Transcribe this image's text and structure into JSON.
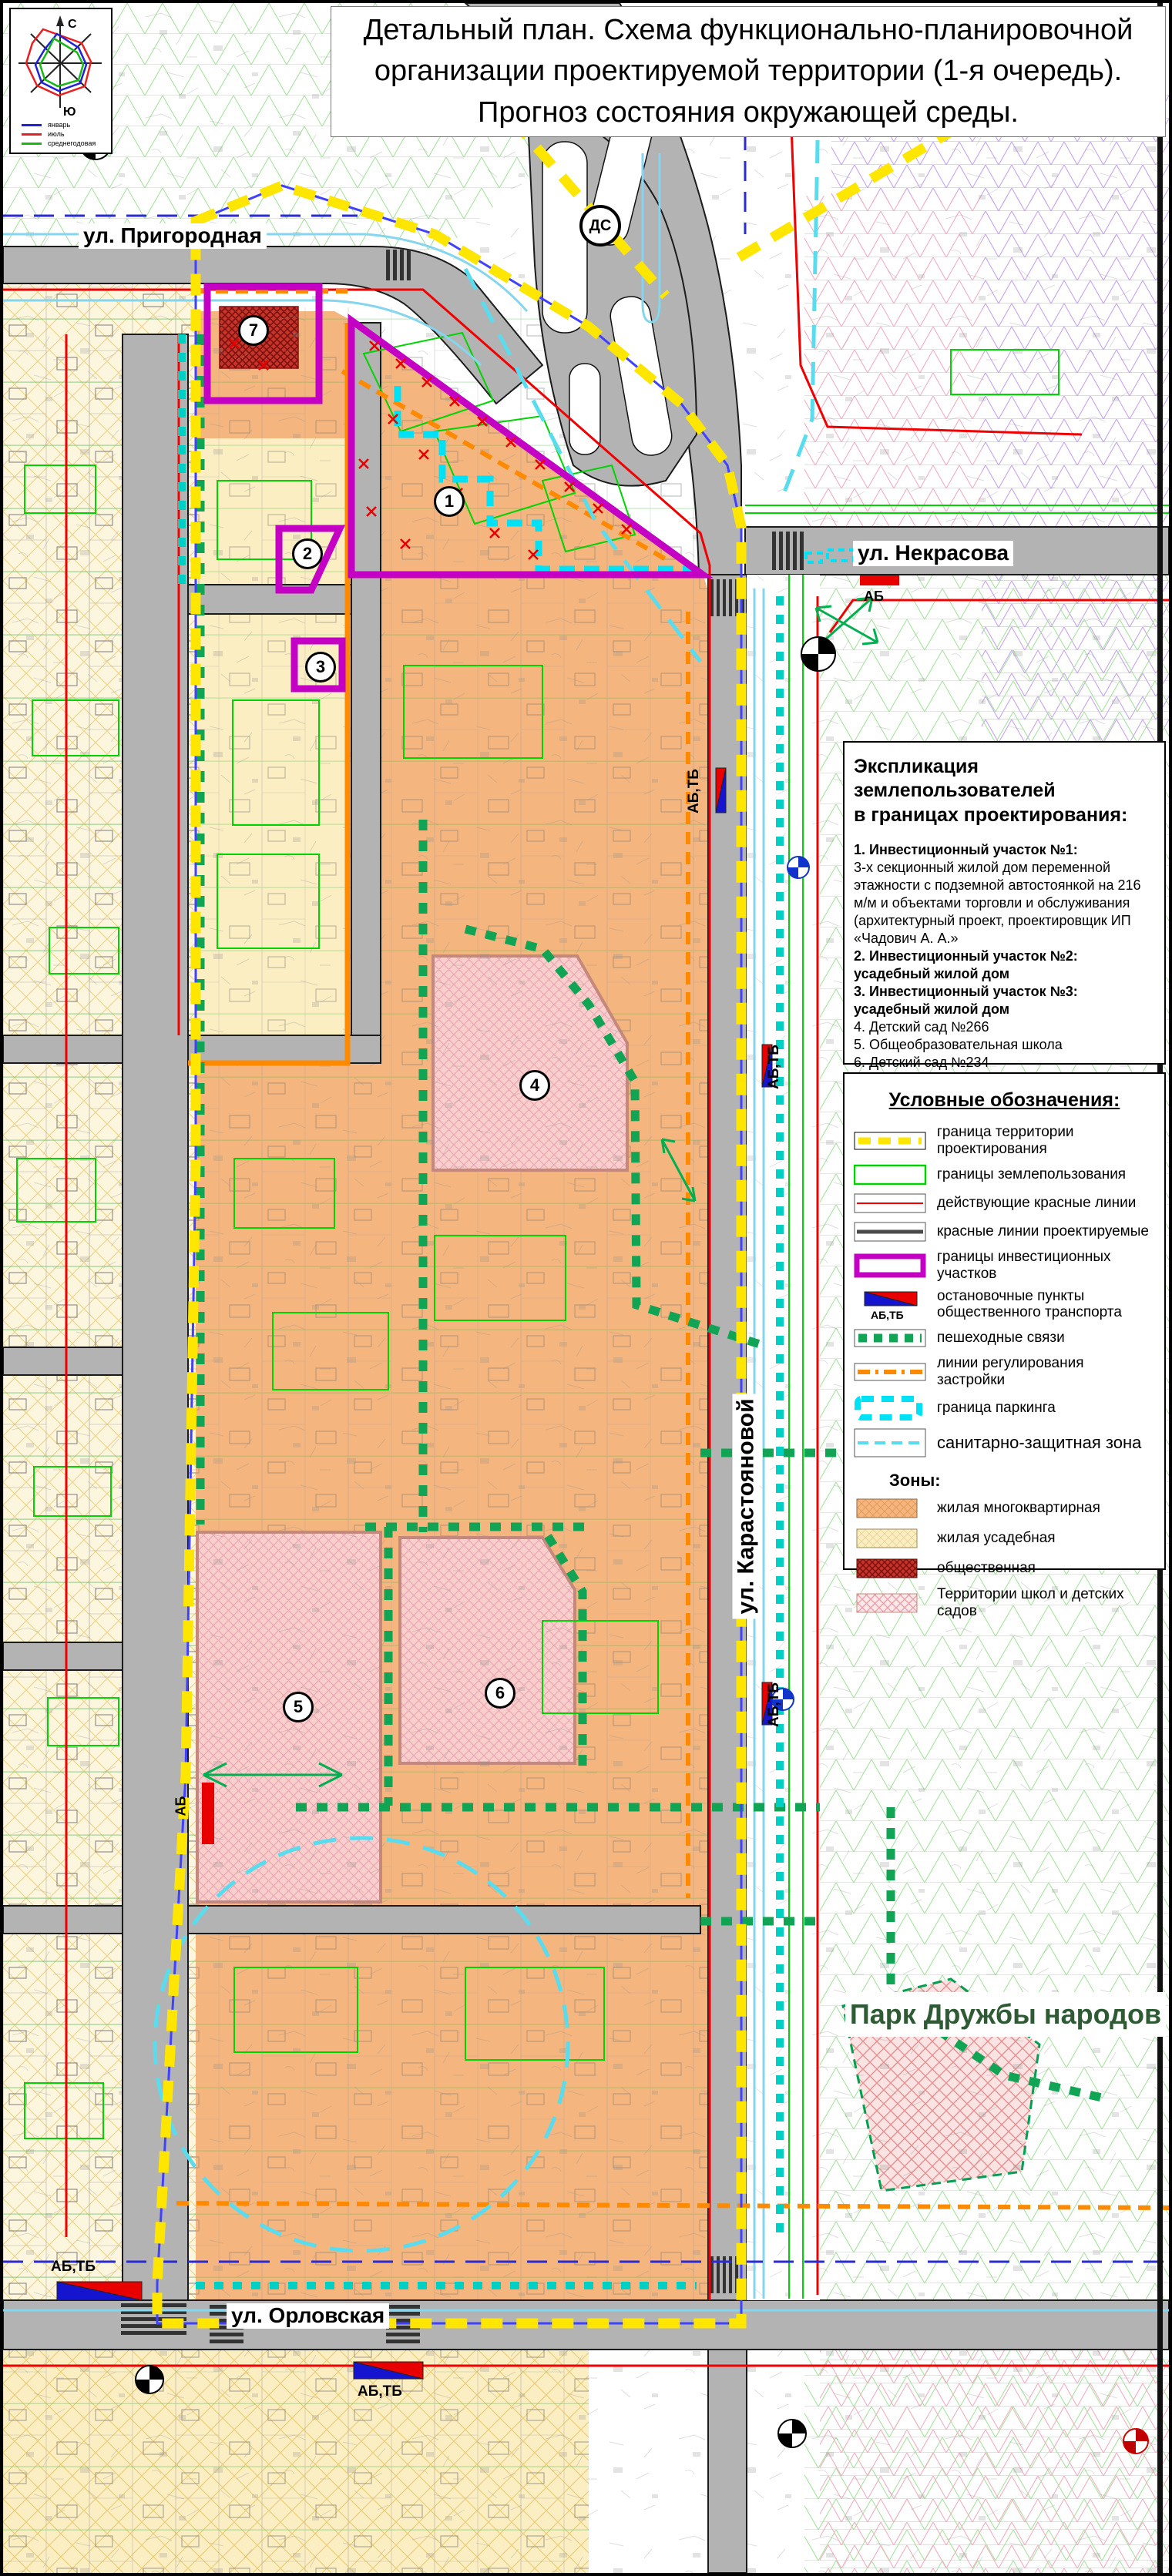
{
  "title": {
    "line1": "Детальный план. Схема функционально-планировочной",
    "line2": "организации проектируемой территории (1-я очередь).",
    "line3": "Прогноз состояния окружающей среды."
  },
  "compass": {
    "north": "С",
    "south": "Ю",
    "legend": [
      {
        "label": "январь",
        "color": "#2020D8"
      },
      {
        "label": "июль",
        "color": "#E82020"
      },
      {
        "label": "среднегодовая",
        "color": "#18B818"
      }
    ]
  },
  "streets": {
    "prigorodnaya": "ул. Пригородная",
    "nekrasova": "ул. Некрасова",
    "karastoyanovoy": "ул. Карастояновой",
    "orlovskaya": "ул. Орловская"
  },
  "park_label": "Парк Дружбы народов",
  "map_markers": {
    "ds": "ДС",
    "ab": "АБ",
    "ab_tb": "АБ,ТБ",
    "site_numbers": [
      "1",
      "2",
      "3",
      "4",
      "5",
      "6",
      "7"
    ]
  },
  "explication": {
    "heading_line1": "Экспликация землепользователей",
    "heading_line2": "в границах проектирования:",
    "items": [
      {
        "text": "1. Инвестиционный участок №1:"
      },
      {
        "text": "3-х секционный жилой дом переменной этажности с подземной автостоянкой на 216 м/м и объектами торговли и обслуживания (архитектурный проект, проектировщик ИП «Чадович А. А.»"
      },
      {
        "text": "2. Инвестиционный участок №2: усадебный жилой дом"
      },
      {
        "text": "3. Инвестиционный участок №3: усадебный жилой дом"
      },
      {
        "text": "4. Детский сад №266"
      },
      {
        "text": "5. Общеобразовательная школа"
      },
      {
        "text": "6. Детский сад №234"
      },
      {
        "text": "7. Административное здание"
      }
    ]
  },
  "legend": {
    "heading": "Условные обозначения:",
    "items": [
      {
        "key": "territory-boundary",
        "label": "граница территории проектирования"
      },
      {
        "key": "landuse-boundaries",
        "label": "границы землепользования"
      },
      {
        "key": "existing-red-lines",
        "label": "действующие красные линии"
      },
      {
        "key": "projected-red-lines",
        "label": "красные линии проектируемые"
      },
      {
        "key": "investment-boundaries",
        "label": "границы инвестиционных участков"
      },
      {
        "key": "transport-stops",
        "label": "остановочные пункты общественного транспорта"
      },
      {
        "key": "pedestrian-links",
        "label": "пешеходные связи"
      },
      {
        "key": "building-regulation-lines",
        "label": "линии регулирования застройки"
      },
      {
        "key": "parking-boundary",
        "label": "граница паркинга"
      },
      {
        "key": "sanitary-zone",
        "label": "санитарно-защитная зона"
      }
    ],
    "zones_heading": "Зоны:",
    "zones": [
      {
        "key": "zone-multiapartment",
        "label": "жилая многоквартирная"
      },
      {
        "key": "zone-usadebnaya",
        "label": "жилая усадебная"
      },
      {
        "key": "zone-public",
        "label": "общественная"
      },
      {
        "key": "zone-schools",
        "label": "Территории школ и детских садов"
      }
    ]
  },
  "colors": {
    "boundary_yellow": "#FFE600",
    "magenta_invest": "#C400C4",
    "regulation_orange": "#FF8A00",
    "parking_cyan": "#00E1F5",
    "pedestrian_green": "#12A455",
    "red_line": "#F00000",
    "road_gray": "#B3B3B3",
    "zone_multiapartment": "#F4B57E",
    "zone_usadebnaya": "#FBEEC3",
    "zone_public": "#C8342A",
    "zone_schools": "#F8CFCB",
    "park_green_text": "#2E5B33"
  }
}
